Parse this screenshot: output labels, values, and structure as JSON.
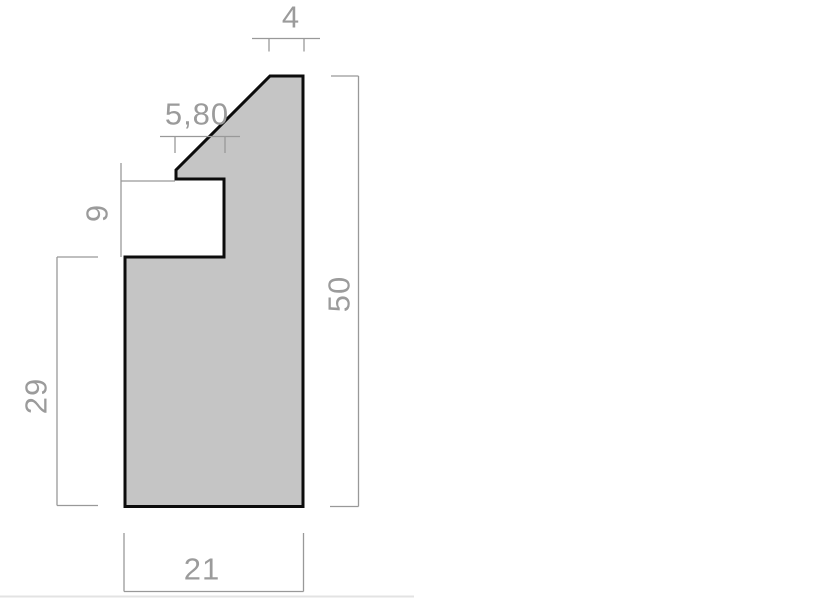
{
  "drawing": {
    "type": "technical-drawing",
    "shape": {
      "name": "moulding-profile",
      "fill_color": "#c5c5c5",
      "outline_color": "#0c0c0c"
    },
    "dimension_style": {
      "line_color": "#999999",
      "text_color": "#9b9b9b"
    },
    "dimensions": {
      "top_width": "4",
      "rebate_width": "5,80",
      "rebate_depth": "9",
      "lower_left_height": "29",
      "overall_height": "50",
      "overall_width": "21"
    },
    "footer_rule_color": "#e3e3e3"
  }
}
